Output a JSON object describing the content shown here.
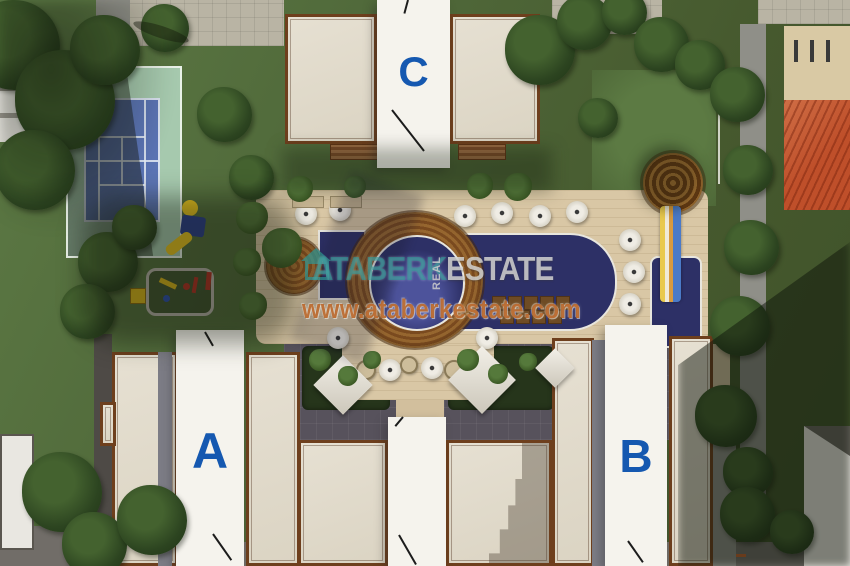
{
  "image_type": "aerial-site-plan-render",
  "buildings": {
    "a": {
      "label": "A"
    },
    "b": {
      "label": "B"
    },
    "c": {
      "label": "C"
    }
  },
  "watermark": {
    "brand_primary": "ATABERK",
    "brand_vertical": "REAL",
    "brand_secondary": "ESTATE",
    "website": "www.ataberkestate.com"
  },
  "colors": {
    "label-blue": "#1558b0",
    "pool-water": "#2d3066",
    "pool-water-light": "#4d539b",
    "deck-tan": "#d9c7a5",
    "wood-ring": "#8a5a28",
    "grass": "#54703d",
    "grass-dark": "#31461f",
    "court-blue": "#5b74b4",
    "court-green": "#a6c9ae",
    "roof-cream": "#e2dccd",
    "roof-white": "#f5f3ed",
    "trim-brown": "#6e3f1d",
    "terrace-gray": "#57525c",
    "plaza-gray": "#b9b4a4",
    "road-gray": "#716d68",
    "slide-tower-brown": "#8a4f1e",
    "tile-roof-orange": "#bf4f2a",
    "watermark-teal": "#2c9694",
    "website-orange": "#ba682c",
    "umbrella-white": "#e9e5dc"
  }
}
